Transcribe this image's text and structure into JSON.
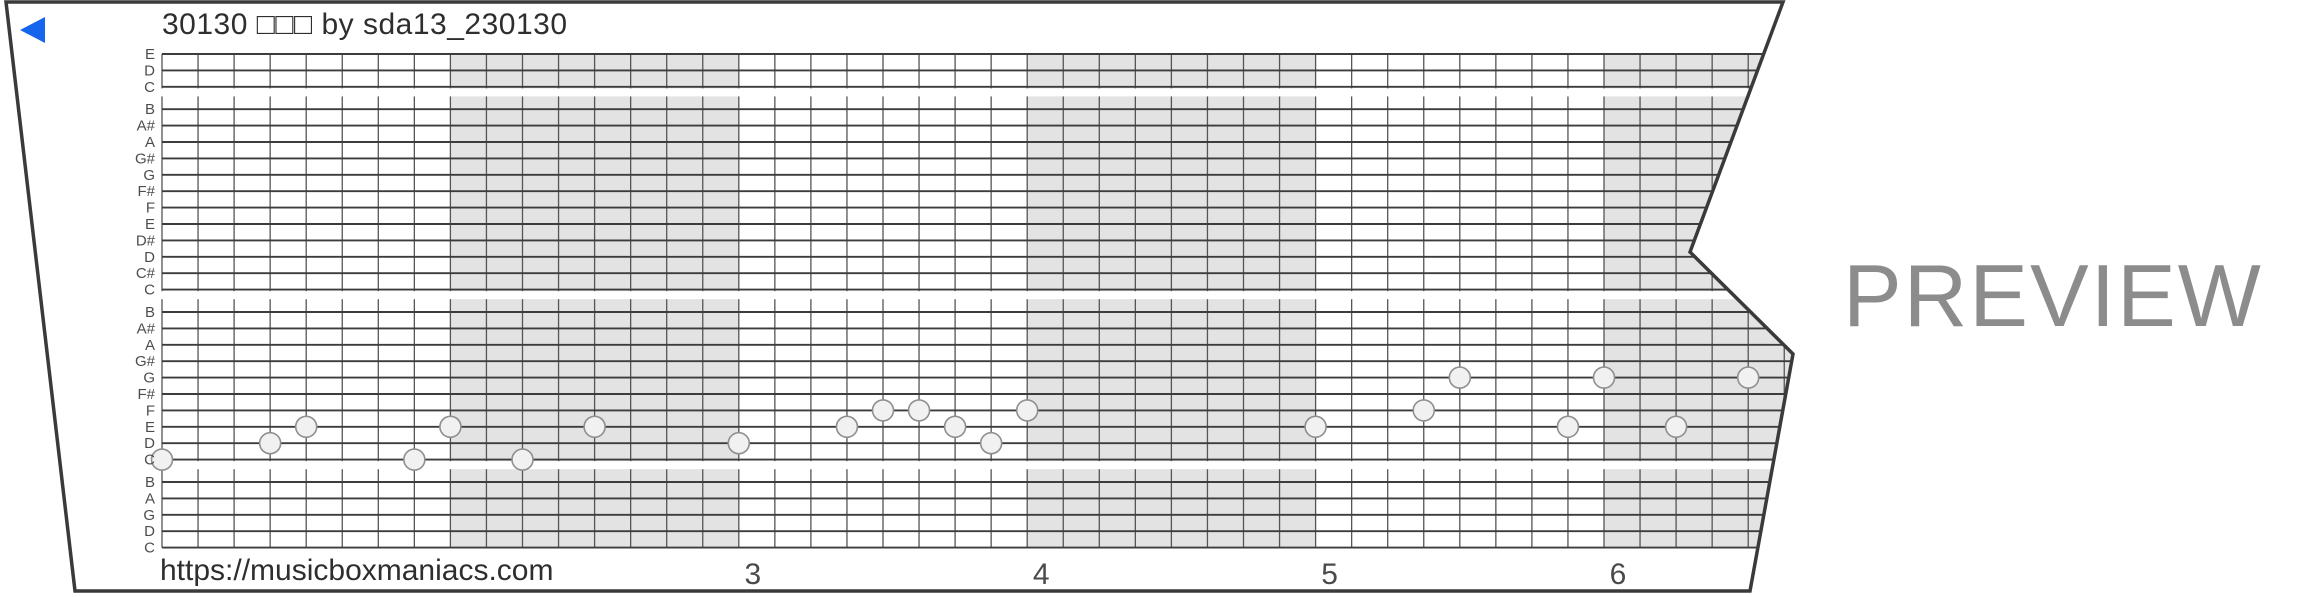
{
  "header": {
    "title": "30130 □□□ by sda13_230130",
    "back_icon": "back-arrow-left",
    "back_color": "#1765ec"
  },
  "watermark": {
    "text": "PREVIEW",
    "color": "#8c8c8c"
  },
  "footer": {
    "url": "https://musicboxmaniacs.com"
  },
  "strip": {
    "pitch_labels_top_to_bottom": [
      "E",
      "D",
      "C",
      "B",
      "A#",
      "A",
      "G#",
      "G",
      "F#",
      "F",
      "E",
      "D#",
      "D",
      "C#",
      "C",
      "B",
      "A#",
      "A",
      "G#",
      "G",
      "F#",
      "F",
      "E",
      "D",
      "C",
      "B",
      "A",
      "G",
      "D",
      "C"
    ],
    "octave_breaks_after_rows": [
      2,
      14,
      24
    ],
    "beats_per_measure": 8,
    "measures_visible": [
      {
        "number": "1",
        "start_beat": 0,
        "shaded": false,
        "number_shown": false
      },
      {
        "number": "2",
        "start_beat": 8,
        "shaded": true,
        "number_shown": false
      },
      {
        "number": "3",
        "start_beat": 16,
        "shaded": false,
        "number_shown": true
      },
      {
        "number": "4",
        "start_beat": 24,
        "shaded": true,
        "number_shown": true
      },
      {
        "number": "5",
        "start_beat": 32,
        "shaded": false,
        "number_shown": true
      },
      {
        "number": "6",
        "start_beat": 40,
        "shaded": true,
        "number_shown": true
      }
    ],
    "notes": [
      {
        "beat": 0,
        "row": 24,
        "pitch": "C4"
      },
      {
        "beat": 3,
        "row": 23,
        "pitch": "D4"
      },
      {
        "beat": 4,
        "row": 22,
        "pitch": "E4"
      },
      {
        "beat": 7,
        "row": 24,
        "pitch": "C4"
      },
      {
        "beat": 8,
        "row": 22,
        "pitch": "E4"
      },
      {
        "beat": 10,
        "row": 24,
        "pitch": "C4"
      },
      {
        "beat": 12,
        "row": 22,
        "pitch": "E4"
      },
      {
        "beat": 16,
        "row": 23,
        "pitch": "D4"
      },
      {
        "beat": 19,
        "row": 22,
        "pitch": "E4"
      },
      {
        "beat": 20,
        "row": 21,
        "pitch": "F4"
      },
      {
        "beat": 21,
        "row": 21,
        "pitch": "F4"
      },
      {
        "beat": 22,
        "row": 22,
        "pitch": "E4"
      },
      {
        "beat": 23,
        "row": 23,
        "pitch": "D4"
      },
      {
        "beat": 24,
        "row": 21,
        "pitch": "F4"
      },
      {
        "beat": 32,
        "row": 22,
        "pitch": "E4"
      },
      {
        "beat": 35,
        "row": 21,
        "pitch": "F4"
      },
      {
        "beat": 36,
        "row": 19,
        "pitch": "G4"
      },
      {
        "beat": 39,
        "row": 22,
        "pitch": "E4"
      },
      {
        "beat": 40,
        "row": 19,
        "pitch": "G4"
      },
      {
        "beat": 42,
        "row": 22,
        "pitch": "E4"
      },
      {
        "beat": 44,
        "row": 19,
        "pitch": "G4"
      }
    ],
    "colors": {
      "border": "#3a3a3a",
      "shading": "#e3e3e3",
      "h_line": "#3c3c3c",
      "v_line": "#555555",
      "note_fill": "#f1f1f1",
      "note_stroke": "#8f8f8f",
      "label": "#4d4d4d",
      "measure_number": "#4a4a4a"
    }
  }
}
